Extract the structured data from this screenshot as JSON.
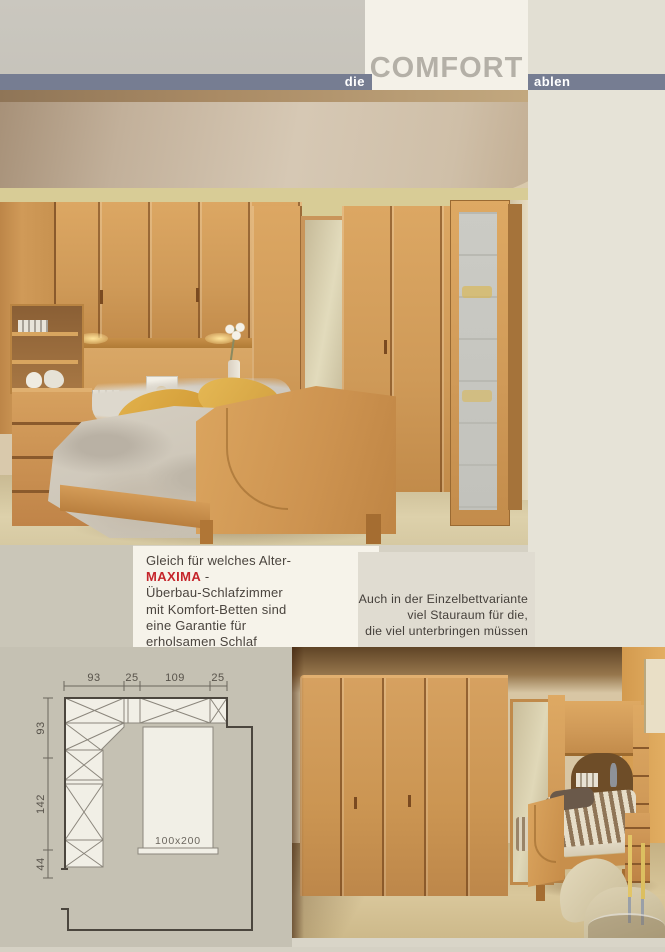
{
  "page": {
    "background": "#d5d1c4"
  },
  "header": {
    "pre": "die",
    "title": "COMFORT",
    "post": "ablen",
    "bar_color": "#767d92",
    "title_color": "#b4b0a7"
  },
  "intro": {
    "line1": "Gleich für welches Alter-",
    "brand": "MAXIMA",
    "brand_suffix": " -",
    "line2": "Überbau-Schlafzimmer",
    "line3": "mit Komfort-Betten sind",
    "line4": "eine Garantie für",
    "line5": "erholsamen Schlaf",
    "brand_color": "#c5252b"
  },
  "single_bed_note": {
    "line1": "Auch in der Einzelbettvariante",
    "line2": "viel Stauraum für die,",
    "line3": "die viel unterbringen müssen"
  },
  "floor_plan": {
    "top_dims": [
      "93",
      "25",
      "109",
      "25"
    ],
    "left_dims": [
      "93",
      "142",
      "44"
    ],
    "bed_label": "100x200",
    "wall_color": "#4b463e",
    "unit_fill": "#f1efe6"
  },
  "colors": {
    "wood": "#cf9a58",
    "carpet": "#d8cba6",
    "plan_background": "#c5c1b3",
    "mirror": "#cfc4a2",
    "accent_wall_orange": "#dca253",
    "pillow_gold": "#d9a53e"
  }
}
